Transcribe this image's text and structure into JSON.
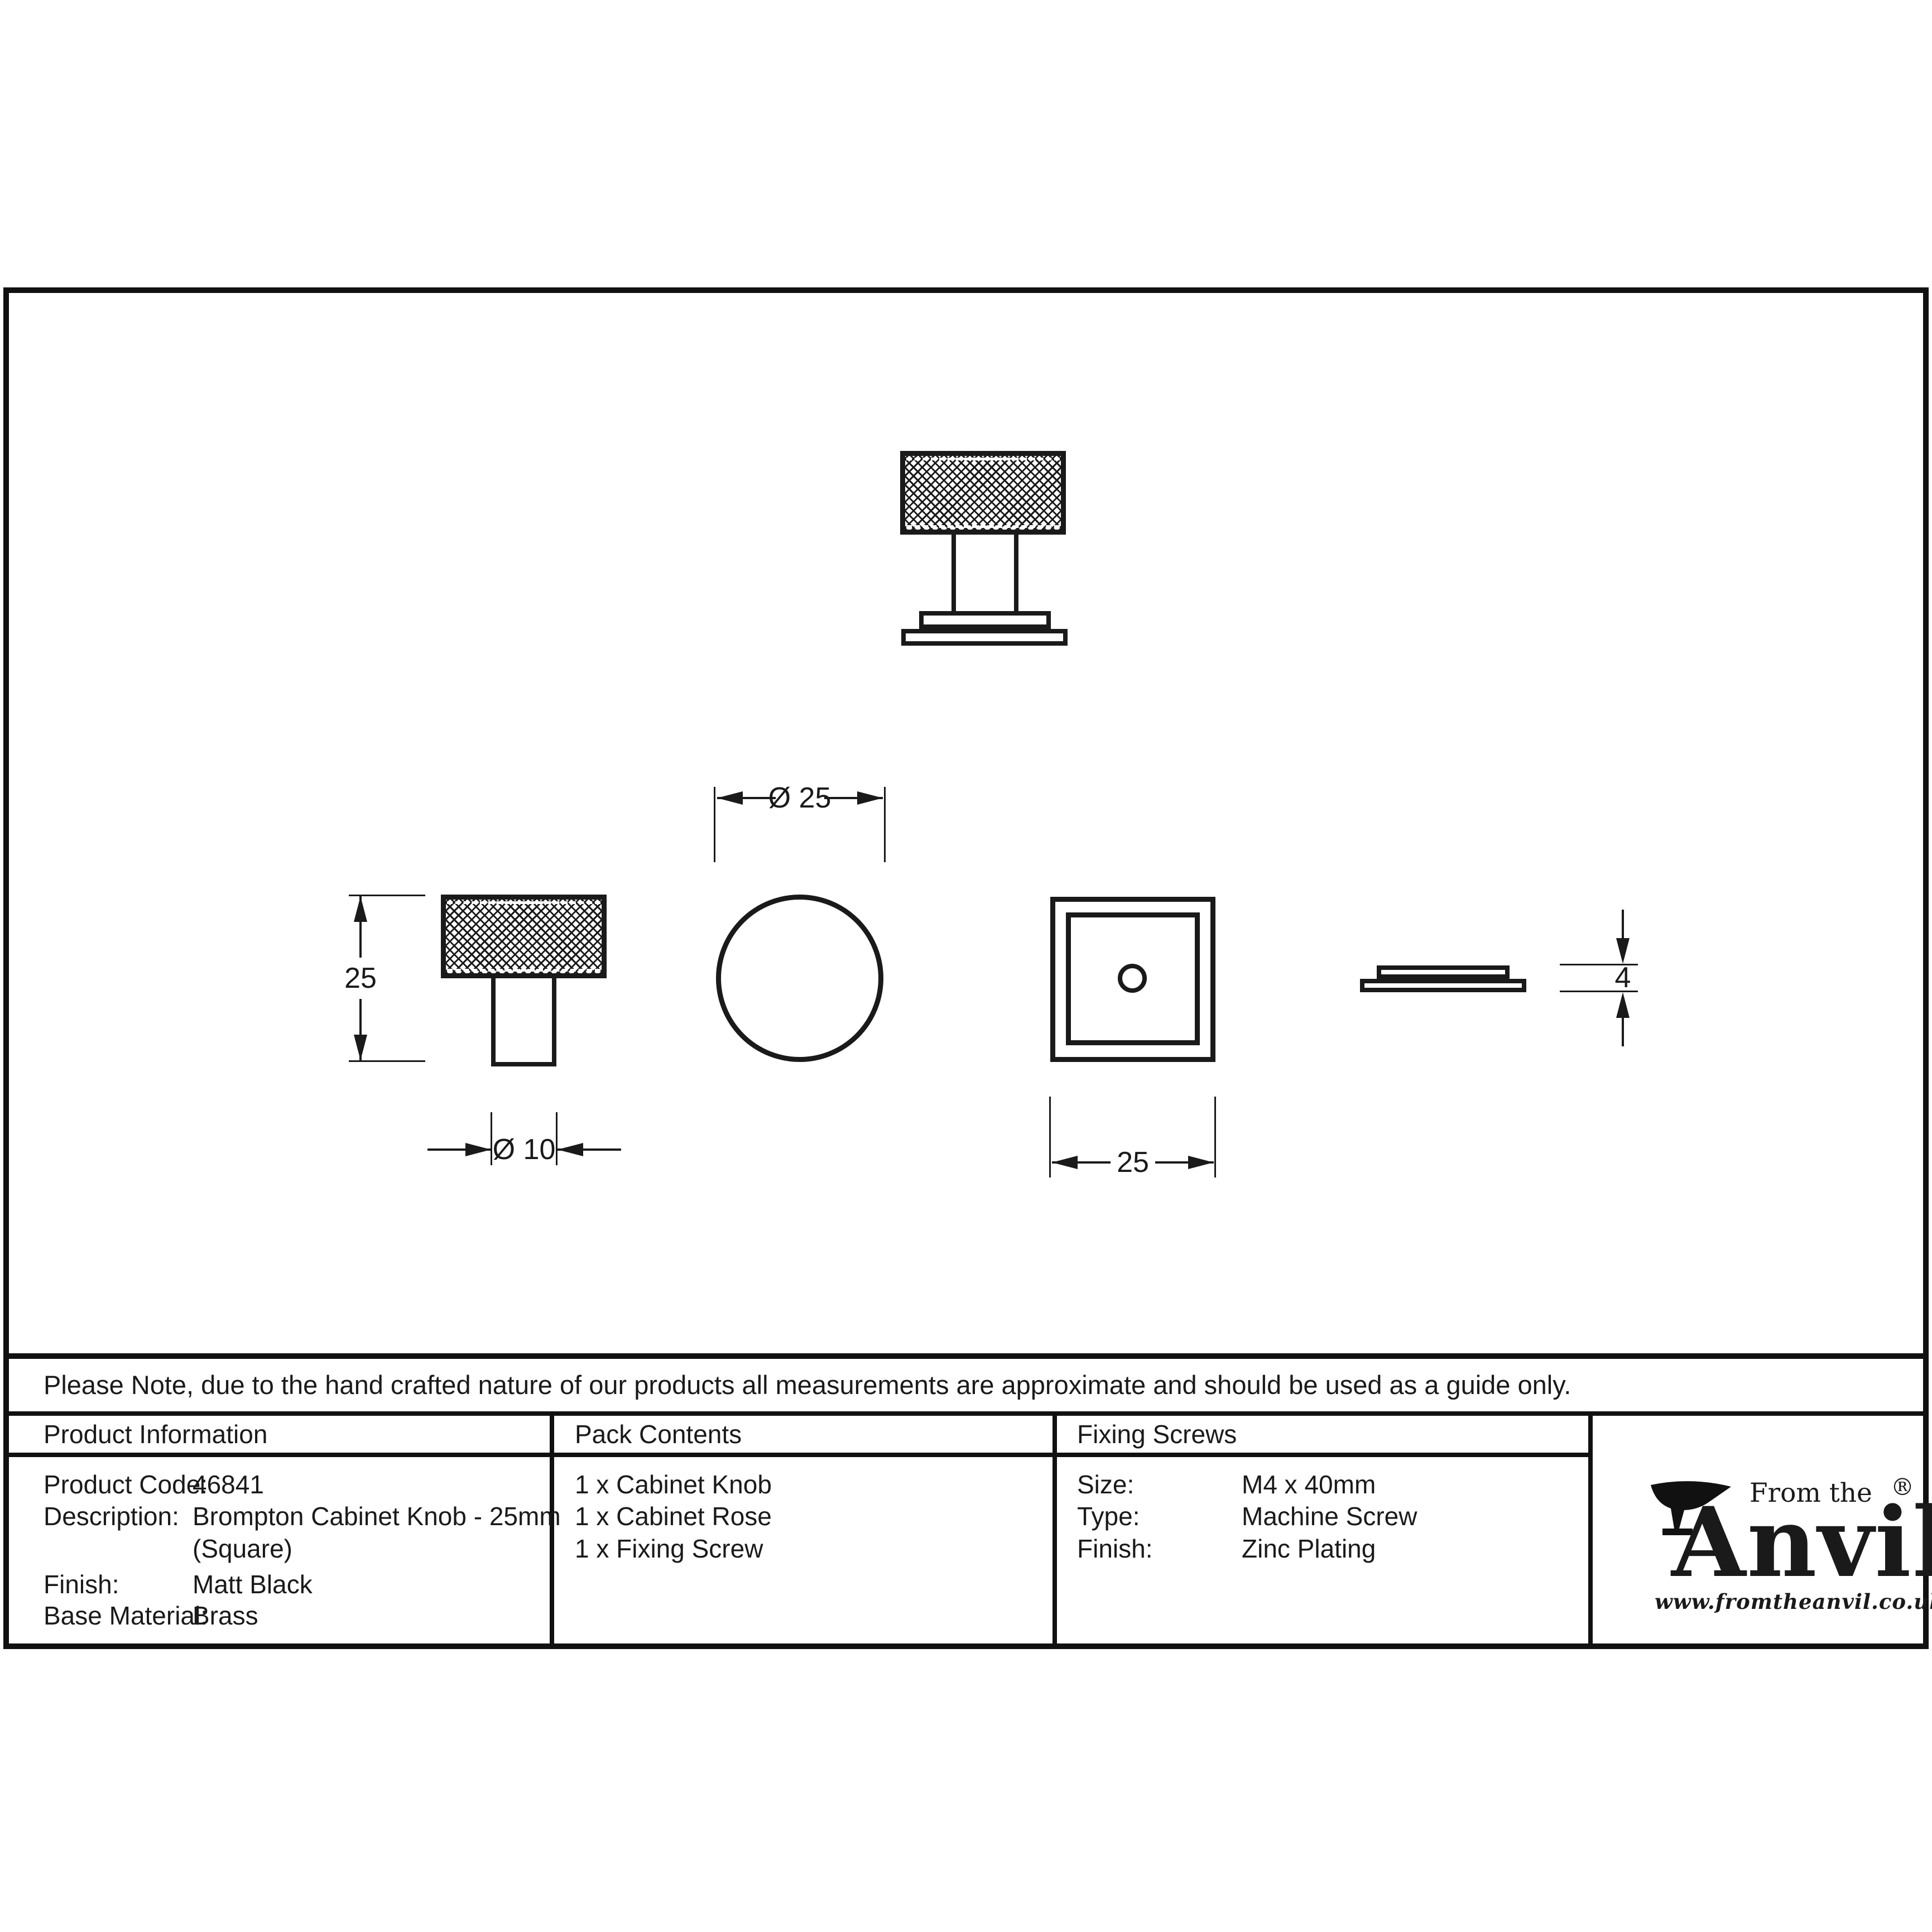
{
  "note": "Please Note, due to the hand crafted nature of our products all measurements are approximate and should be used as a guide only.",
  "table": {
    "product_information": {
      "header": "Product Information",
      "rows": [
        {
          "label": "Product Code:",
          "value": "46841"
        },
        {
          "label": "Description:",
          "value": "Brompton Cabinet Knob - 25mm"
        },
        {
          "label": "",
          "value": "(Square)"
        },
        {
          "label": "Finish:",
          "value": "Matt Black"
        },
        {
          "label": "Base Material:",
          "value": "Brass"
        }
      ]
    },
    "pack_contents": {
      "header": "Pack Contents",
      "items": [
        "1 x Cabinet Knob",
        "1 x Cabinet Rose",
        "1 x Fixing Screw"
      ]
    },
    "fixing_screws": {
      "header": "Fixing Screws",
      "rows": [
        {
          "label": "Size:",
          "value": "M4 x 40mm"
        },
        {
          "label": "Type:",
          "value": "Machine Screw"
        },
        {
          "label": "Finish:",
          "value": "Zinc Plating"
        }
      ]
    }
  },
  "dimensions": {
    "knob_height": "25",
    "stem_diameter": "Ø 10",
    "knob_diameter": "Ø 25",
    "square_width": "25",
    "rose_thickness": "4"
  },
  "logo": {
    "from_the": "From the",
    "brand": "Anvil",
    "registered": "®",
    "url": "www.fromtheanvil.co.uk"
  },
  "colors": {
    "line": "#1a1a1a",
    "border": "#111111",
    "background": "#ffffff"
  }
}
